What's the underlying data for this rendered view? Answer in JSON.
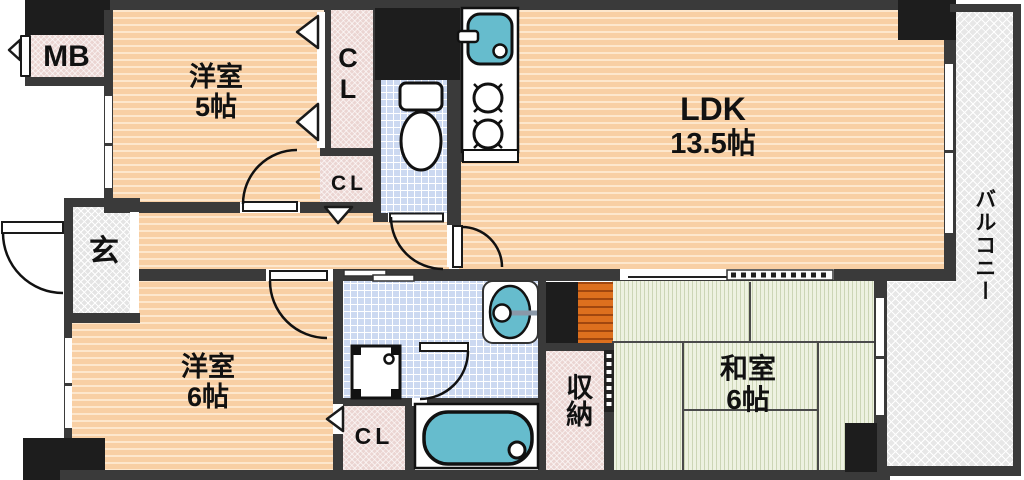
{
  "plan_labels": {
    "mb": "MB",
    "room5_name": "洋室",
    "room5_size": "5帖",
    "cl": "CL",
    "cl_c": "C",
    "cl_l": "L",
    "ldk_name": "LDK",
    "ldk_size": "13.5帖",
    "balcony": "バルコニー",
    "entry": "玄",
    "room6_name": "洋室",
    "room6_size": "6帖",
    "storage": "収納",
    "tatami_name": "和室",
    "tatami_size": "6帖"
  },
  "colors": {
    "wall": "#3a3a3a",
    "shaft": "#1d1d1d",
    "floor_wood": "#f8cfa4",
    "floor_stripe": "#fde7cd",
    "closet_pink": "#ebd5d2",
    "tile_blue": "#ccd9f1",
    "fixture_teal": "#66bccd",
    "tatami_green": "#eef2e1",
    "wood_orange": "#dd701e",
    "entry_gray": "#e4e4e4",
    "balcony_gray": "#e7e7e7",
    "line": "#111111"
  }
}
